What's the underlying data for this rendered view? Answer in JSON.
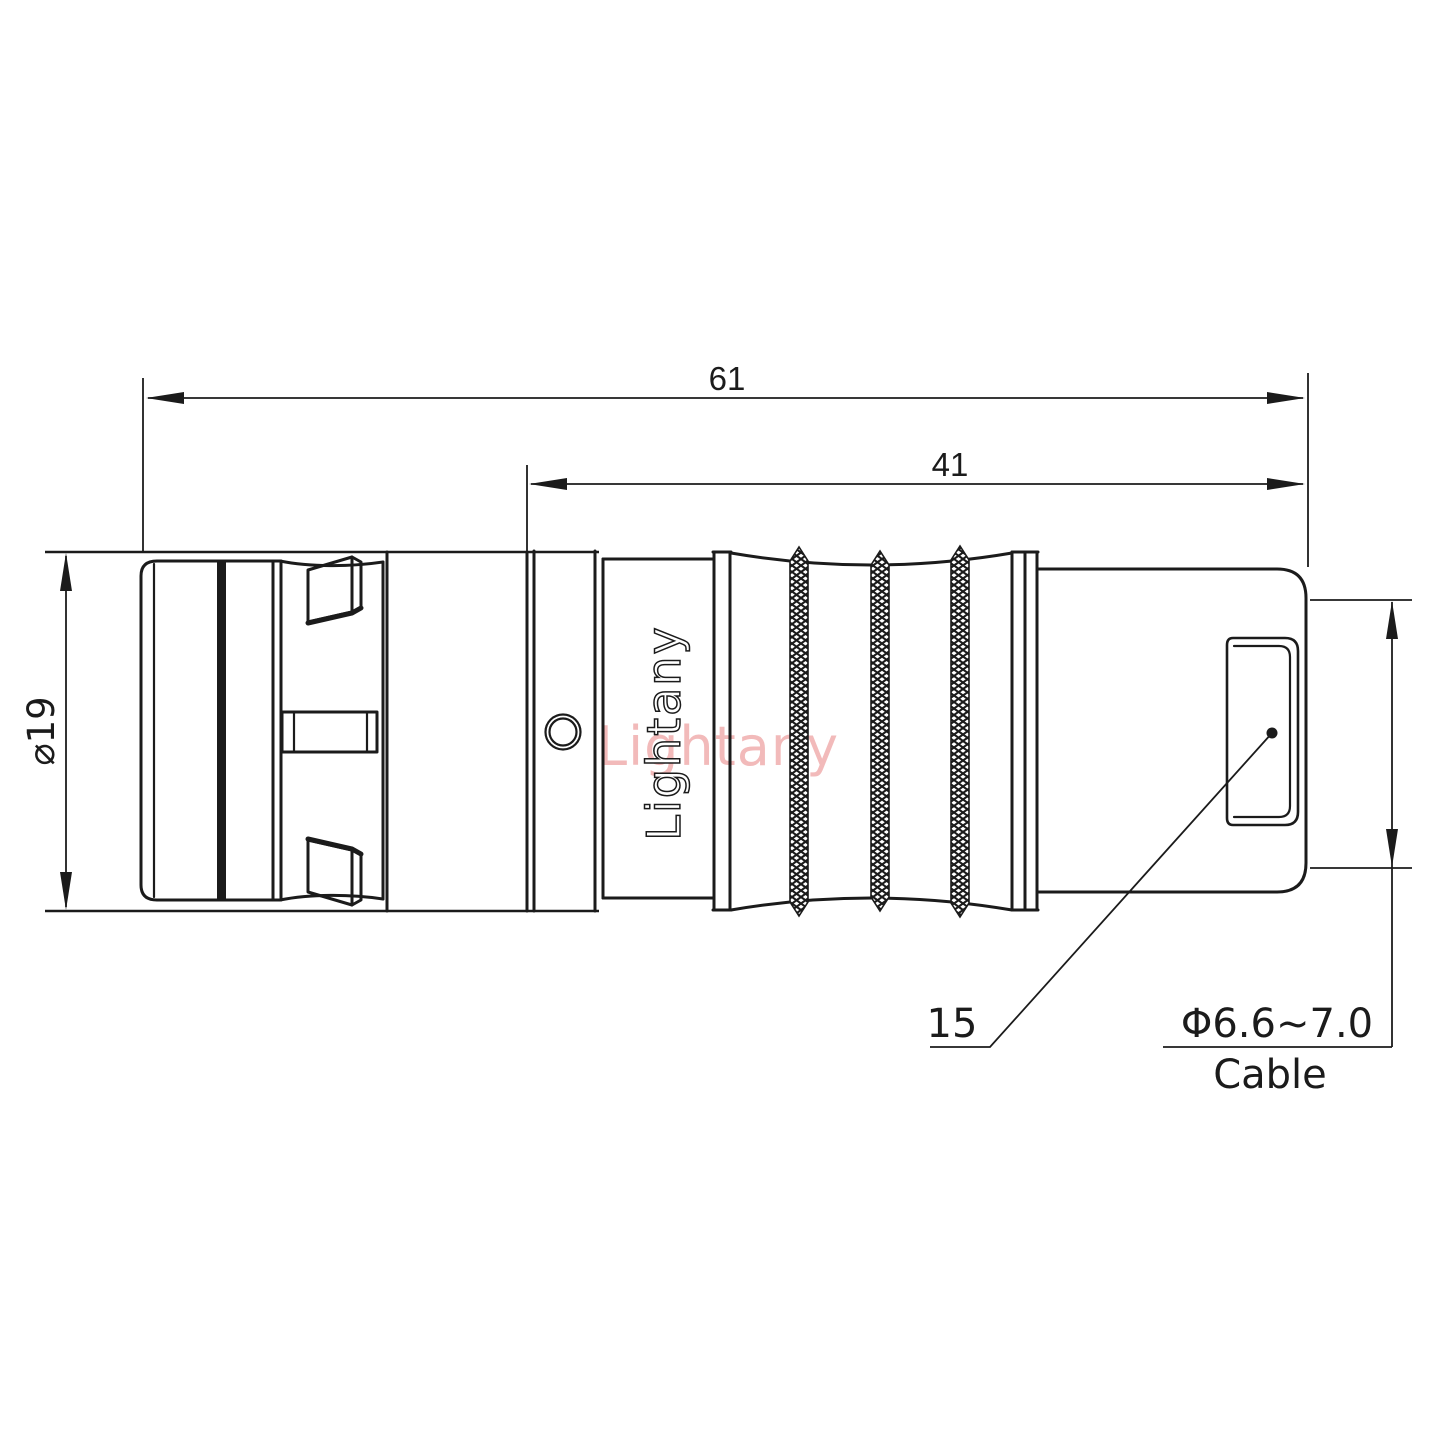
{
  "drawing": {
    "brand_engraving": "Lightany",
    "watermark": "Lightany",
    "dims": {
      "overall_length": "61",
      "rear_length": "41",
      "outer_diameter": "⌀19",
      "backshell_callout": "15",
      "cable_diameter_range": "Φ6.6~7.0",
      "cable_word": "Cable"
    },
    "colors": {
      "line": "#1b1b1b",
      "watermark": "#f2baba",
      "background": "#ffffff"
    }
  }
}
